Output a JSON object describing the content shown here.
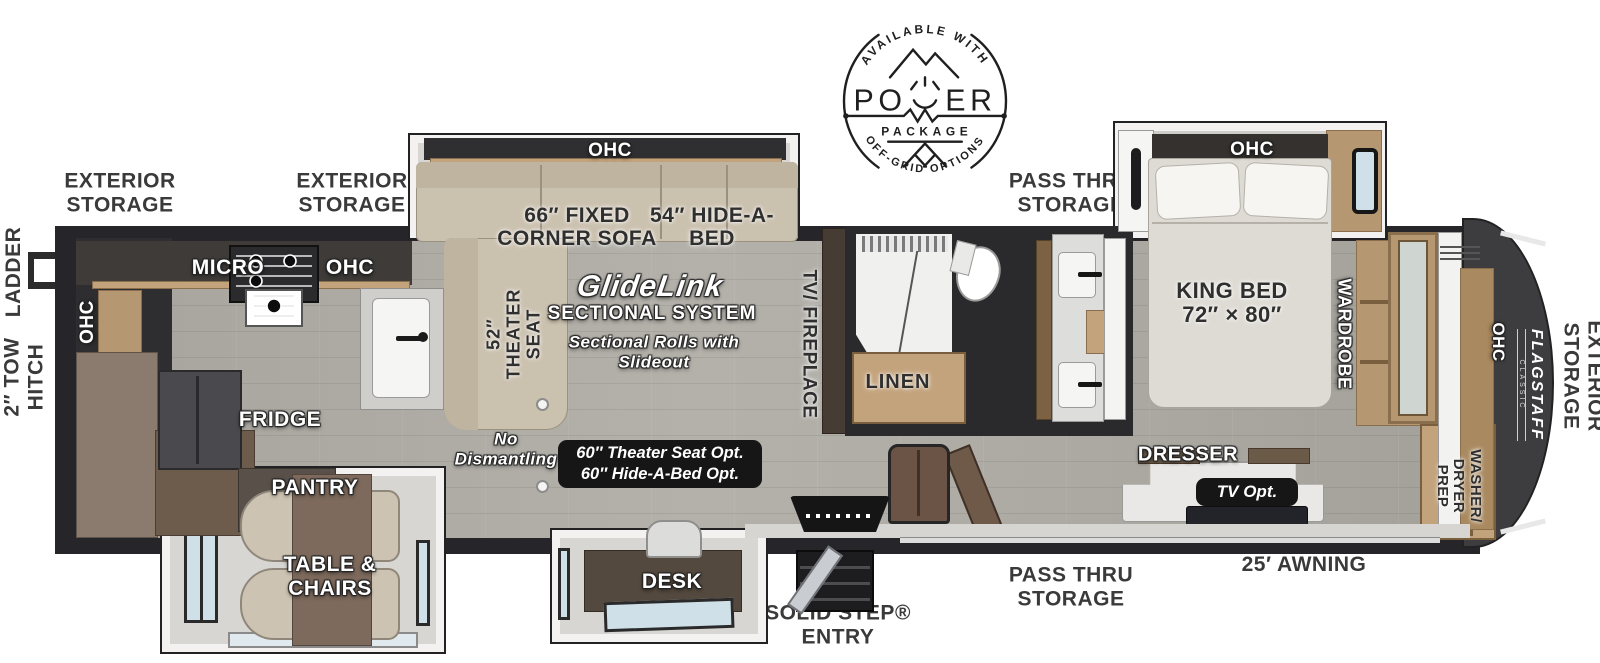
{
  "badge": {
    "top_arc": "AVAILABLE WITH",
    "power_left": "PO",
    "power_right": "ER",
    "package": "PACKAGE",
    "bottom_arc": "OFF-GRID OPTIONS"
  },
  "exterior": {
    "rear_storage_a": "EXTERIOR\nSTORAGE",
    "rear_storage_b": "EXTERIOR\nSTORAGE",
    "ladder": "LADDER",
    "tow_hitch": "2″ TOW\nHITCH",
    "pass_thru_top": "PASS THRU\nSTORAGE",
    "pass_thru_bottom": "PASS THRU\nSTORAGE",
    "awning": "25′ AWNING",
    "solid_step": "SOLID STEP®\nENTRY",
    "front_storage": "EXTERIOR\nSTORAGE"
  },
  "kitchen": {
    "ohc_rear": "OHC",
    "micro": "MICRO",
    "ohc": "OHC",
    "fridge": "FRIDGE",
    "pantry": "PANTRY",
    "table_chairs": "TABLE &\nCHAIRS"
  },
  "living": {
    "ohc": "OHC",
    "corner_sofa": "66″ FIXED\nCORNER SOFA",
    "hide_a_bed": "54″ HIDE-A-\nBED",
    "theater_seat": "52″\nTHEATER\nSEAT",
    "glide_logo": "GlideLink",
    "sectional_system": "SECTIONAL SYSTEM",
    "sectional_note": "Sectional Rolls with\nSlideout",
    "no_dismantling": "No\nDismantling",
    "options": "60″ Theater Seat Opt.\n60″ Hide-A-Bed Opt.",
    "tv_fireplace": "TV/ FIREPLACE"
  },
  "bath": {
    "linen": "LINEN"
  },
  "bedroom": {
    "ohc": "OHC",
    "king_bed": "KING BED\n72″ × 80″",
    "wardrobe": "WARDROBE",
    "dresser": "DRESSER",
    "tv_opt": "TV Opt."
  },
  "office": {
    "desk": "DESK"
  },
  "front": {
    "ohc": "OHC",
    "washer_dryer": "WASHER/\nDRYER\nPREP",
    "brand": "FLAGSTAFF",
    "brand_sub": "CLASSIC"
  },
  "colors": {
    "wall": "#26262a",
    "floor": "#b0ada6",
    "slide_floor": "#d8d6d3",
    "wood": "#c3a37c",
    "dark_wood": "#6d5b4c",
    "sofa_beige": "#cbc1af",
    "option_badge_bg": "#161616",
    "front_cap": "#3d3d40",
    "label_dark": "#3a3a3a"
  }
}
